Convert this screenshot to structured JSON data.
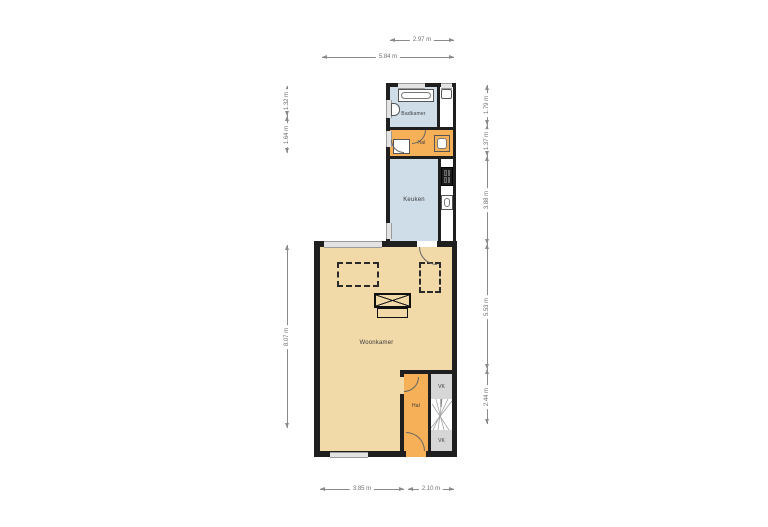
{
  "colors": {
    "wall": "#1f1f1f",
    "badkamer": "#cfdde9",
    "keuken": "#cfdde9",
    "hal": "#f5b058",
    "woonkamer": "#f1d9a8",
    "closet": "#d6d6d6",
    "window": "#e3e3e3",
    "dimension": "#8a8a8a"
  },
  "rooms": {
    "badkamer": {
      "label": "Badkamer"
    },
    "hal_boven": {
      "label": "Hal"
    },
    "keuken": {
      "label": "Keuken"
    },
    "woonkamer": {
      "label": "Woonkamer"
    },
    "hal_beneden": {
      "label": "Hal"
    },
    "vk_boven": {
      "label": "VK"
    },
    "vk_beneden": {
      "label": "VK"
    }
  },
  "dimensions": {
    "top": [
      {
        "label": "2.97 m"
      },
      {
        "label": "5.84 m"
      }
    ],
    "bottom": [
      {
        "label": "3.85 m"
      },
      {
        "label": "2.10 m"
      }
    ],
    "left": [
      {
        "label": "1.32 m"
      },
      {
        "label": "1.64 m"
      },
      {
        "label": "8.07 m"
      }
    ],
    "right": [
      {
        "label": "1.79 m"
      },
      {
        "label": "1.37 m"
      },
      {
        "label": "3.88 m"
      },
      {
        "label": "5.53 m"
      },
      {
        "label": "2.44 m"
      }
    ]
  }
}
